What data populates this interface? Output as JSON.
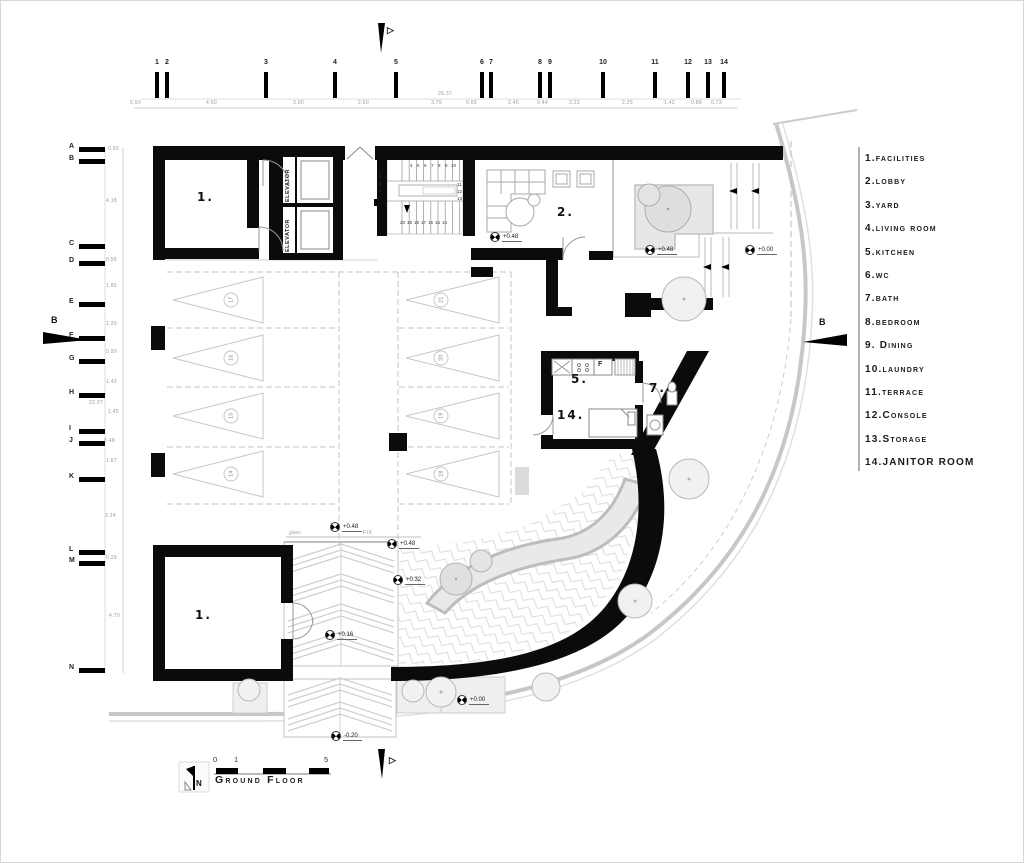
{
  "titleblock": {
    "title": "Ground Floor",
    "north": "N",
    "scale": [
      "0",
      "1",
      "5"
    ]
  },
  "legend": {
    "items": [
      "1.facilities",
      "2.lobby",
      "3.yard",
      "4.living room",
      "5.kitchen",
      "6.wc",
      "7.bath",
      "8.bedroom",
      "9. Dining",
      "10.laundry",
      "11.terrace",
      "12.Console",
      "13.Storage",
      "14.JANITOR ROOM"
    ]
  },
  "grid": {
    "cols": [
      {
        "t": "1",
        "x": 156
      },
      {
        "t": "2",
        "x": 166
      },
      {
        "t": "3",
        "x": 265
      },
      {
        "t": "4",
        "x": 334
      },
      {
        "t": "5",
        "x": 395
      },
      {
        "t": "6",
        "x": 481
      },
      {
        "t": "7",
        "x": 490
      },
      {
        "t": "8",
        "x": 539
      },
      {
        "t": "9",
        "x": 549
      },
      {
        "t": "10",
        "x": 602
      },
      {
        "t": "11",
        "x": 654
      },
      {
        "t": "12",
        "x": 687
      },
      {
        "t": "13",
        "x": 707
      },
      {
        "t": "14",
        "x": 723
      }
    ],
    "rows": [
      {
        "t": "A",
        "y": 146
      },
      {
        "t": "B",
        "y": 158
      },
      {
        "t": "C",
        "y": 243
      },
      {
        "t": "D",
        "y": 260
      },
      {
        "t": "E",
        "y": 301
      },
      {
        "t": "F",
        "y": 335
      },
      {
        "t": "G",
        "y": 358
      },
      {
        "t": "H",
        "y": 392
      },
      {
        "t": "I",
        "y": 428
      },
      {
        "t": "J",
        "y": 440
      },
      {
        "t": "K",
        "y": 476
      },
      {
        "t": "L",
        "y": 549
      },
      {
        "t": "M",
        "y": 560
      },
      {
        "t": "N",
        "y": 667
      }
    ]
  },
  "dims": {
    "top": [
      {
        "t": "0.50",
        "x": 129,
        "y": 100
      },
      {
        "t": "4.50",
        "x": 205,
        "y": 100
      },
      {
        "t": "3.00",
        "x": 292,
        "y": 100
      },
      {
        "t": "2.60",
        "x": 357,
        "y": 100
      },
      {
        "t": "3.75",
        "x": 430,
        "y": 100
      },
      {
        "t": "0.65",
        "x": 465,
        "y": 100
      },
      {
        "t": "2.45",
        "x": 507,
        "y": 100
      },
      {
        "t": "0.44",
        "x": 536,
        "y": 100
      },
      {
        "t": "3.23",
        "x": 568,
        "y": 100
      },
      {
        "t": "2.25",
        "x": 621,
        "y": 100
      },
      {
        "t": "1.42",
        "x": 663,
        "y": 100
      },
      {
        "t": "0.88",
        "x": 690,
        "y": 100
      },
      {
        "t": "0.73",
        "x": 710,
        "y": 100
      },
      {
        "t": "26.37",
        "x": 437,
        "y": 91
      }
    ],
    "left": [
      {
        "t": "0.93",
        "x": 107,
        "y": 146
      },
      {
        "t": "4.18",
        "x": 105,
        "y": 198
      },
      {
        "t": "0.56",
        "x": 105,
        "y": 257
      },
      {
        "t": "1.85",
        "x": 105,
        "y": 283
      },
      {
        "t": "1.39",
        "x": 105,
        "y": 321
      },
      {
        "t": "0.99",
        "x": 105,
        "y": 349
      },
      {
        "t": "1.42",
        "x": 105,
        "y": 379
      },
      {
        "t": "1.45",
        "x": 107,
        "y": 409
      },
      {
        "t": "0.48",
        "x": 103,
        "y": 438
      },
      {
        "t": "1.67",
        "x": 105,
        "y": 458
      },
      {
        "t": "3.24",
        "x": 104,
        "y": 513
      },
      {
        "t": "0.29",
        "x": 105,
        "y": 555
      },
      {
        "t": "4.70",
        "x": 108,
        "y": 613
      },
      {
        "t": "22.27",
        "x": 88,
        "y": 400
      }
    ]
  },
  "rooms": [
    {
      "t": "1.",
      "x": 196,
      "y": 190
    },
    {
      "t": "2.",
      "x": 556,
      "y": 205
    },
    {
      "t": "5.",
      "x": 570,
      "y": 372
    },
    {
      "t": "7.",
      "x": 648,
      "y": 381
    },
    {
      "t": "14.",
      "x": 556,
      "y": 408
    },
    {
      "t": "1.",
      "x": 194,
      "y": 608
    }
  ],
  "fridge": {
    "t": "F",
    "x": 597,
    "y": 360
  },
  "elevators": [
    {
      "t": "ELEVATOR",
      "x": 285,
      "y": 201
    },
    {
      "t": "ELEVATOR",
      "x": 285,
      "y": 251
    }
  ],
  "stairs": {
    "numbers": [
      {
        "t": "4",
        "x": 409,
        "y": 163
      },
      {
        "t": "5",
        "x": 416,
        "y": 163
      },
      {
        "t": "6",
        "x": 423,
        "y": 163
      },
      {
        "t": "7",
        "x": 430,
        "y": 163
      },
      {
        "t": "8",
        "x": 437,
        "y": 163
      },
      {
        "t": "9",
        "x": 444,
        "y": 163
      },
      {
        "t": "10",
        "x": 450,
        "y": 163
      },
      {
        "t": "11",
        "x": 456,
        "y": 182
      },
      {
        "t": "12",
        "x": 456,
        "y": 189
      },
      {
        "t": "13",
        "x": 456,
        "y": 196
      },
      {
        "t": "20",
        "x": 399,
        "y": 220
      },
      {
        "t": "19",
        "x": 406,
        "y": 220
      },
      {
        "t": "18",
        "x": 413,
        "y": 220
      },
      {
        "t": "17",
        "x": 420,
        "y": 220
      },
      {
        "t": "16",
        "x": 427,
        "y": 220
      },
      {
        "t": "15",
        "x": 434,
        "y": 220
      },
      {
        "t": "14",
        "x": 441,
        "y": 220
      },
      {
        "t": "3",
        "x": 378,
        "y": 174
      },
      {
        "t": "2",
        "x": 378,
        "y": 181
      },
      {
        "t": "1",
        "x": 378,
        "y": 188
      }
    ]
  },
  "parking": [
    {
      "t": "17",
      "x": 228,
      "y": 296
    },
    {
      "t": "16",
      "x": 228,
      "y": 354
    },
    {
      "t": "15",
      "x": 228,
      "y": 412
    },
    {
      "t": "14",
      "x": 228,
      "y": 470
    },
    {
      "t": "21",
      "x": 438,
      "y": 296
    },
    {
      "t": "20",
      "x": 438,
      "y": 354
    },
    {
      "t": "19",
      "x": 438,
      "y": 412
    },
    {
      "t": "18",
      "x": 438,
      "y": 470
    }
  ],
  "levels": [
    {
      "t": "+0.48",
      "x": 489,
      "y": 231
    },
    {
      "t": "+0.48",
      "x": 644,
      "y": 244
    },
    {
      "t": "+0.00",
      "x": 744,
      "y": 244
    },
    {
      "t": "+0.48",
      "x": 329,
      "y": 521
    },
    {
      "t": "+0.48",
      "x": 386,
      "y": 538
    },
    {
      "t": "+0.32",
      "x": 392,
      "y": 574
    },
    {
      "t": "+0.16",
      "x": 324,
      "y": 629
    },
    {
      "t": "+0.00",
      "x": 456,
      "y": 694
    },
    {
      "t": "-0.20",
      "x": 330,
      "y": 730
    }
  ],
  "annotations": [
    {
      "t": "FIX",
      "x": 362,
      "y": 530
    },
    {
      "t": "glass",
      "x": 288,
      "y": 530
    }
  ],
  "sections": [
    {
      "t": "B",
      "x": 50,
      "y": 315
    },
    {
      "t": "B",
      "x": 818,
      "y": 317
    },
    {
      "t": "▷",
      "x": 386,
      "y": 25
    },
    {
      "t": "▷",
      "x": 388,
      "y": 755
    }
  ],
  "colors": {
    "wall": "#0b0b0b",
    "light_line": "#c7c7c7",
    "gray_fill": "#e7e7e7",
    "dim_text": "#9a9a9a"
  }
}
